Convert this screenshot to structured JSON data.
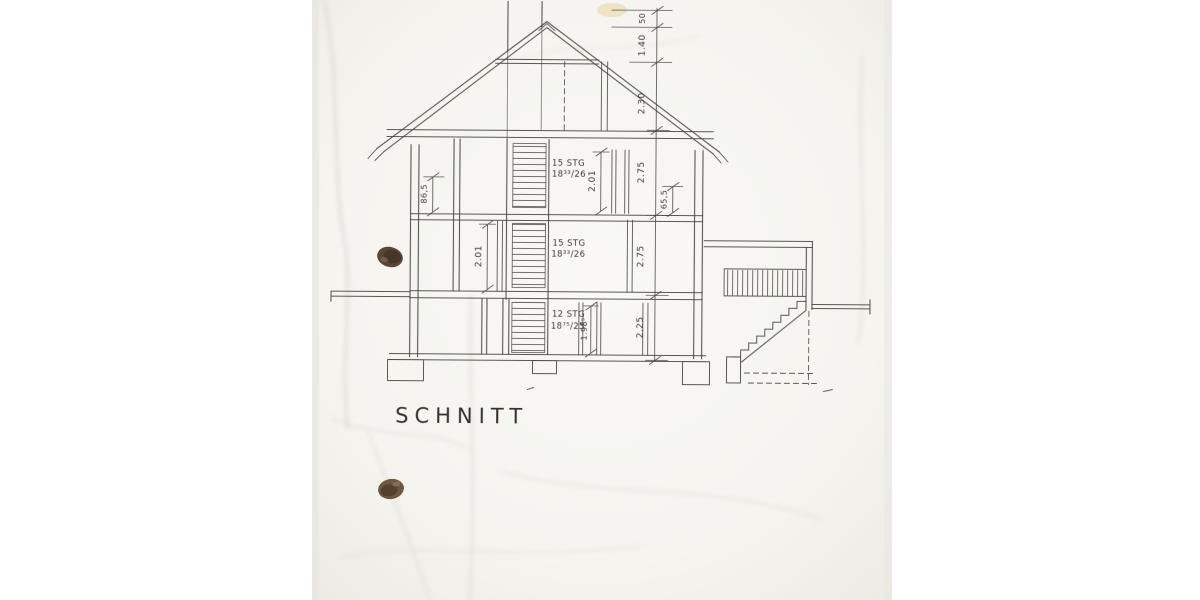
{
  "drawing": {
    "title": "SCHNITT"
  },
  "labels": {
    "stair_attic_steps": "15 STG",
    "stair_attic_ratio": "18³³/26",
    "stair_ground_steps": "15 STG",
    "stair_ground_ratio": "18³³/26",
    "stair_basement_steps": "12 STG",
    "stair_basement_ratio": "18⁷⁵/25"
  },
  "dimensions": {
    "chain": [
      "50",
      "1.40",
      "2.30",
      "2.75",
      "2.75",
      "2.25"
    ],
    "door_upper": "2.01",
    "door_ground": "2.01",
    "door_basement": "1.98⁵",
    "parapet_left": "86,5",
    "lintel_right": "65,5"
  },
  "colors": {
    "ink": "#45423c",
    "paper": "#f6f5f1",
    "punch_hole": "#5a4636"
  }
}
